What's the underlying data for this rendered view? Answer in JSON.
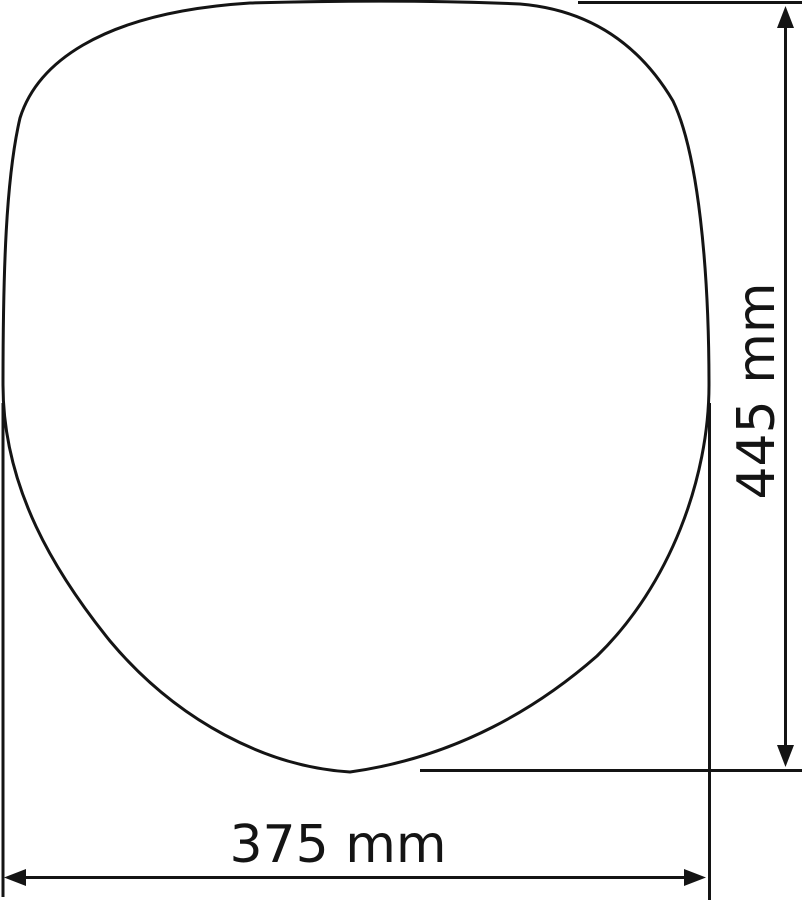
{
  "diagram": {
    "background_color": "#ffffff",
    "line_color": "#141414",
    "shape_name": "seat-outline",
    "dimensions": {
      "height": {
        "label": "445 mm",
        "value": 445,
        "unit": "mm",
        "orientation": "vertical"
      },
      "width": {
        "label": "375 mm",
        "value": 375,
        "unit": "mm",
        "orientation": "horizontal"
      }
    }
  }
}
